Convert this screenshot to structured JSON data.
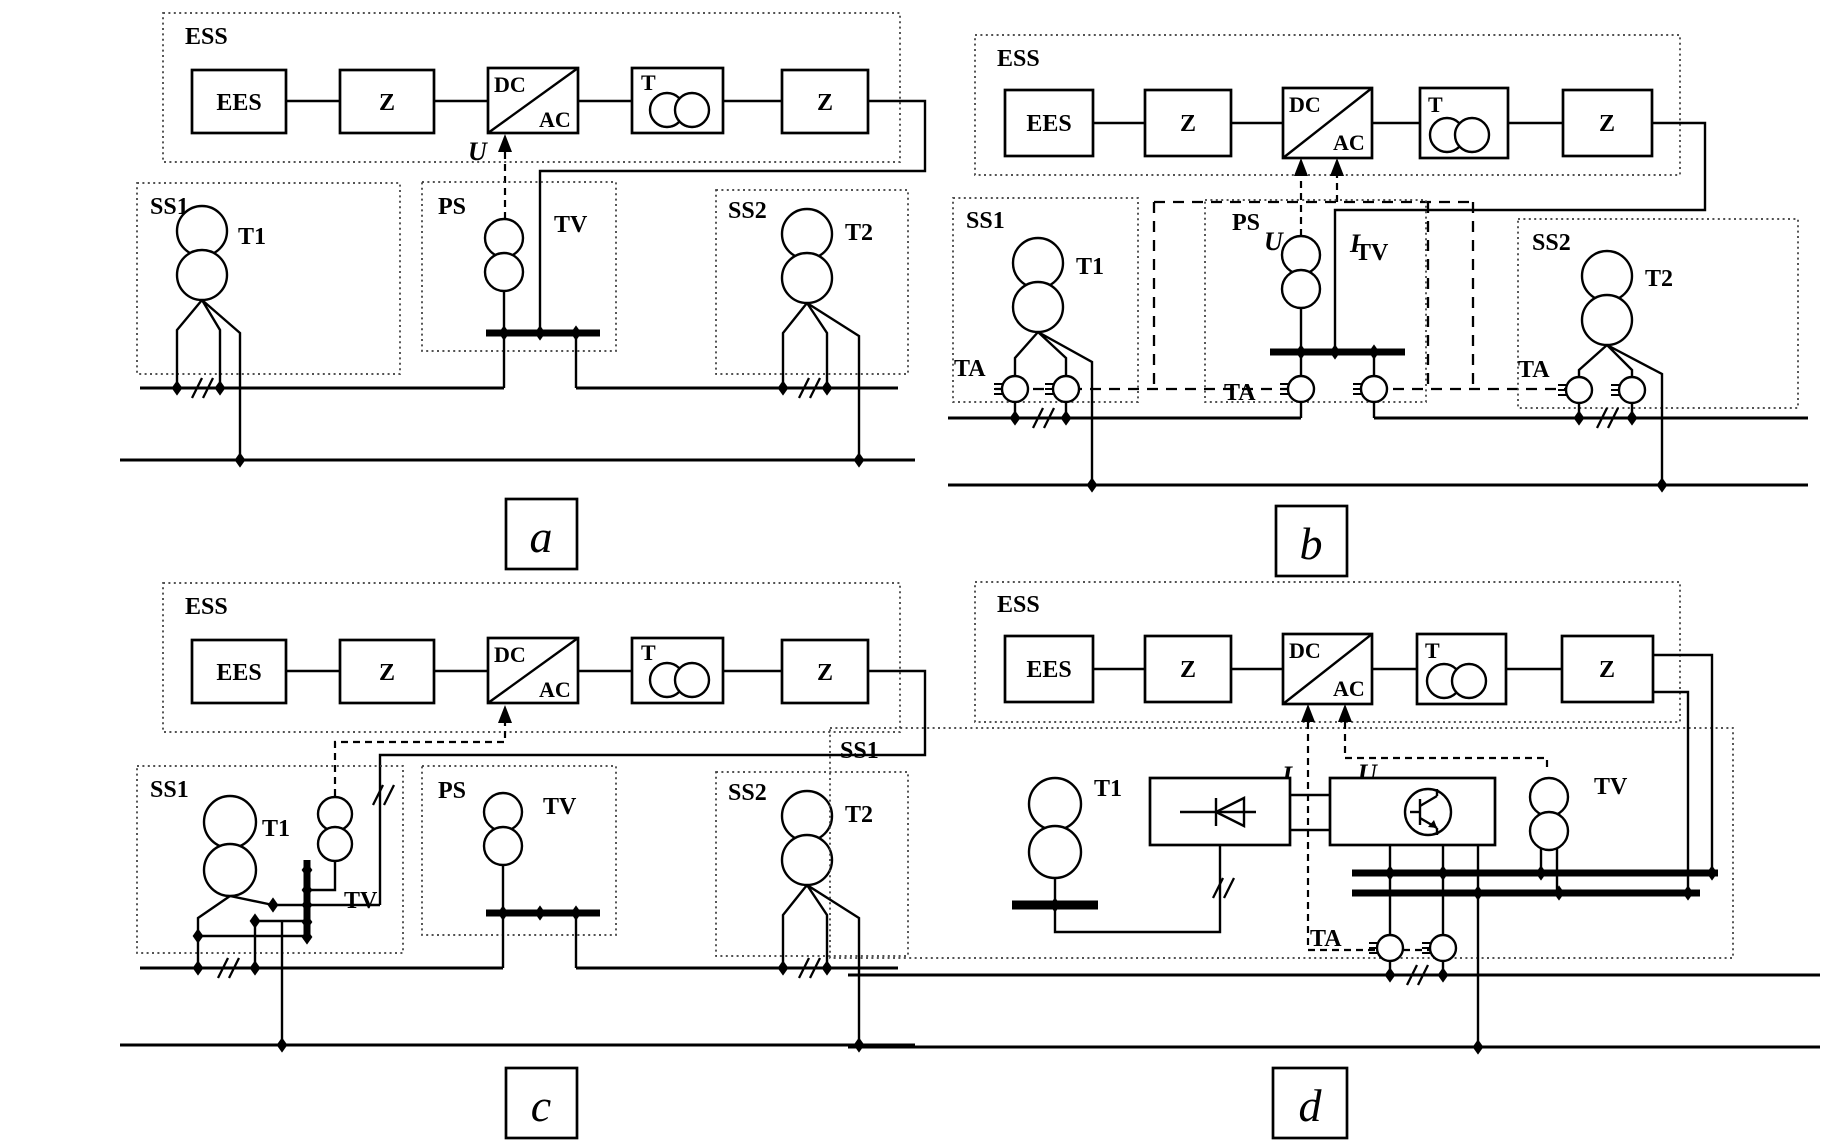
{
  "title": "ESS connection scheme variants for traction power supply",
  "colors": {
    "ink": "#000000",
    "dotted_border": "#3a3a3a",
    "background": "#ffffff"
  },
  "panel_a": {
    "ess_label": "ESS",
    "ees": "EES",
    "z_left": "Z",
    "dc": "DC",
    "ac": "AC",
    "t": "T",
    "z_right": "Z",
    "u_signal": "U",
    "ss1": "SS1",
    "t1": "T1",
    "ps": "PS",
    "tv": "TV",
    "ss2": "SS2",
    "t2": "T2",
    "caption": "a"
  },
  "panel_b": {
    "ess_label": "ESS",
    "ees": "EES",
    "z_left": "Z",
    "dc": "DC",
    "ac": "AC",
    "t": "T",
    "z_right": "Z",
    "u_signal": "U",
    "i_signal": "I",
    "ss1": "SS1",
    "t1": "T1",
    "ta_ss1": "TA",
    "ps": "PS",
    "tv": "TV",
    "ta_ps": "TA",
    "ss2": "SS2",
    "t2": "T2",
    "ta_ss2": "TA",
    "caption": "b"
  },
  "panel_c": {
    "ess_label": "ESS",
    "ees": "EES",
    "z_left": "Z",
    "dc": "DC",
    "ac": "AC",
    "t": "T",
    "z_right": "Z",
    "ss1": "SS1",
    "t1": "T1",
    "tv_ss1": "TV",
    "ps": "PS",
    "tv_ps": "TV",
    "ss2": "SS2",
    "t2": "T2",
    "caption": "c"
  },
  "panel_d": {
    "ess_label": "ESS",
    "ees": "EES",
    "z_left": "Z",
    "dc": "DC",
    "ac": "AC",
    "t": "T",
    "z_right": "Z",
    "i_signal": "I",
    "u_signal": "U",
    "ss1": "SS1",
    "t1": "T1",
    "tv": "TV",
    "ta": "TA",
    "caption": "d"
  }
}
